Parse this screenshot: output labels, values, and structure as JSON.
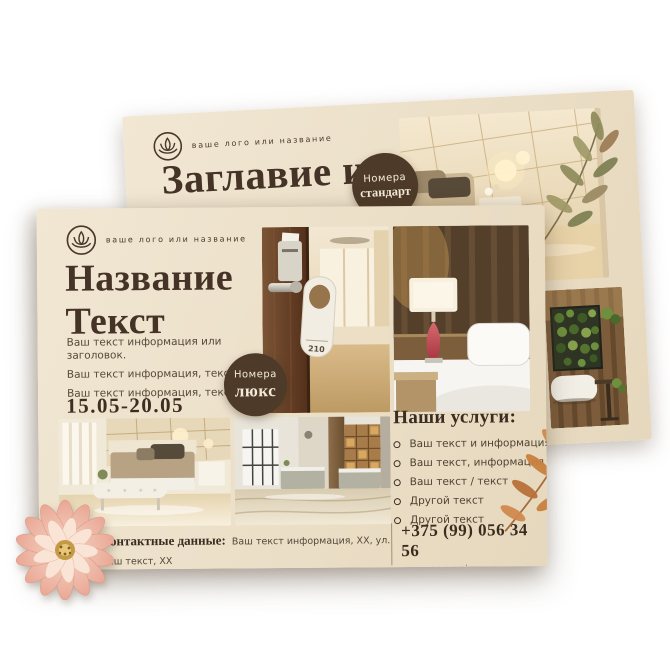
{
  "back_flyer": {
    "logo_text": "ваше лого или название",
    "title_line1": "Заглавие илиБ",
    "title_line2": "информация",
    "badge_line1": "Номера",
    "badge_line2": "стандарт"
  },
  "front_flyer": {
    "logo_text": "ваше лого или название",
    "title_line1": "Название",
    "title_line2": "Текст",
    "body_line1": "Ваш текст информация или заголовок.",
    "body_line2": "Ваш текст информация, текст",
    "body_line3": "Ваш текст информация, текст",
    "date_range": "15.05-20.05",
    "badge_line1": "Номера",
    "badge_line2": "люкс",
    "door_tag_number": "210",
    "services_heading": "Наши услуги:",
    "services": [
      "Ваш текст и информация",
      "Ваш текст, информация",
      "Ваш текст / текст",
      "Другой текст",
      "Другой текст"
    ],
    "contacts_label": "Контактные данные:",
    "contacts_line1": "Ваш текст информация, XX, ул. Ваш текст, XX",
    "contacts_line2": "Информация, XX-XX, Ваш текст информация, XX, ул. Ваш текст, XX,",
    "phone": "+375 (99) 056 34 56",
    "website": "www. nazvanie.com"
  },
  "colors": {
    "paper": "#ece0c9",
    "ink": "#443326",
    "badge": "#4d3a28",
    "leaf_orange": "#c9813f",
    "leaf_green": "#8f8a5c",
    "flower_pink": "#eaa795"
  }
}
